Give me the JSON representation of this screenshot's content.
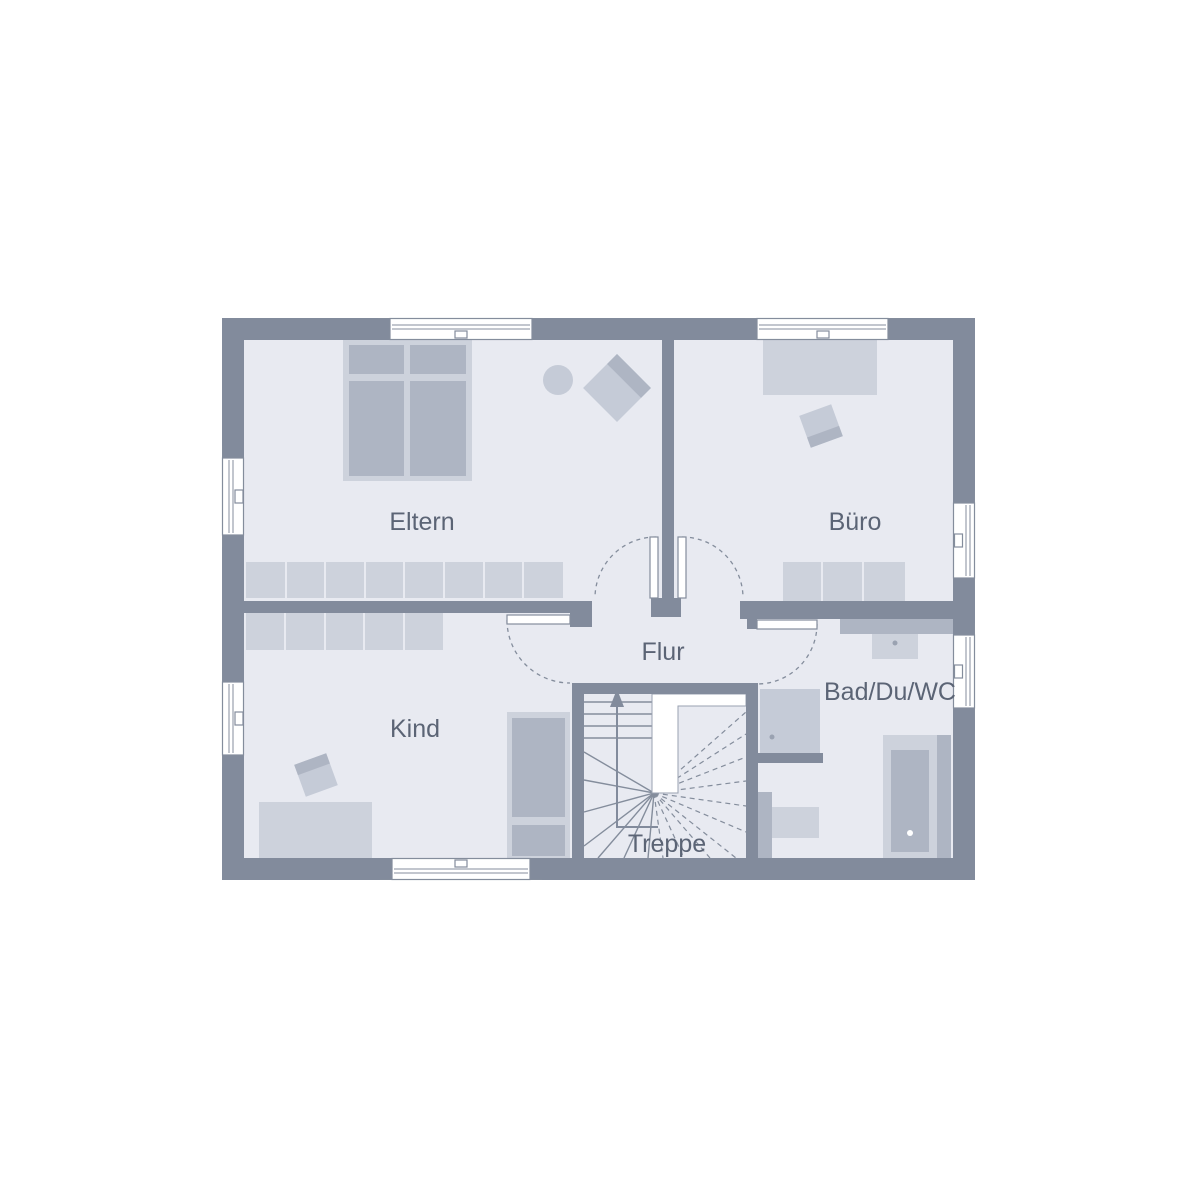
{
  "palette": {
    "bg": "#ffffff",
    "wall": "#828b9c",
    "floor": "#e8eaf1",
    "furnLight": "#cdd2dc",
    "furnMid": "#c5cbd7",
    "furnDark": "#aeb5c3",
    "line": "#848d9c",
    "text": "#5b6475",
    "dot": "#9aa2b1"
  },
  "plan": {
    "type": "floor-plan-upper-storey",
    "rooms": {
      "eltern": {
        "label": "Eltern",
        "furniture": [
          "double-bed",
          "round-stool",
          "armchair",
          "wardrobe-8-segments"
        ]
      },
      "buero": {
        "label": "Büro",
        "furniture": [
          "desk",
          "office-chair",
          "sideboard-3-segments"
        ]
      },
      "kind": {
        "label": "Kind",
        "furniture": [
          "wardrobe-5-segments",
          "desk",
          "chair",
          "single-bed"
        ]
      },
      "flur": {
        "label": "Flur"
      },
      "bad": {
        "label": "Bad/Du/WC",
        "furniture": [
          "vanity-washbasin",
          "shower",
          "wc",
          "bathtub"
        ]
      },
      "treppe": {
        "label": "Treppe",
        "feature": "winder-staircase",
        "walk_direction": "up"
      }
    },
    "openings": {
      "windows": 7,
      "doors": 4
    }
  }
}
